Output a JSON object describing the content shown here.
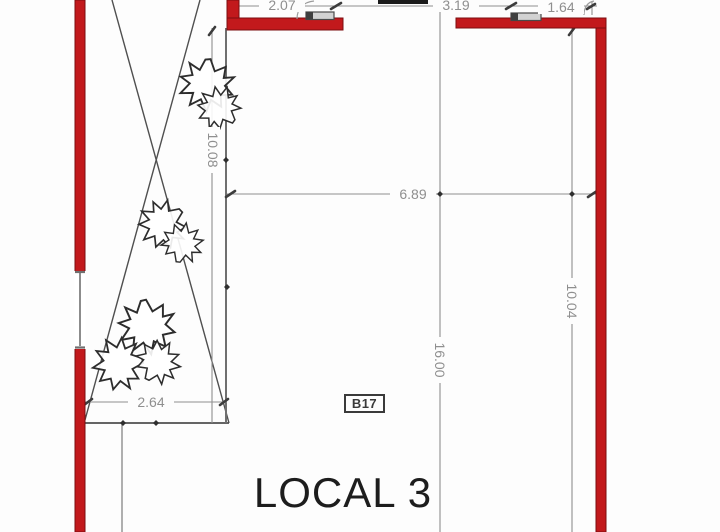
{
  "plan": {
    "room_label": "LOCAL 3",
    "unit_code": "B17",
    "dimensions": {
      "top_left": "2.07",
      "top_middle": "3.19",
      "top_right": "1.64",
      "left_height": "10.08",
      "interior_width": "6.89",
      "center_height": "16.00",
      "right_height": "10.04",
      "planter_width": "2.64"
    },
    "colors": {
      "wall_fill": "#c2191c",
      "wall_edge": "#7c0d10",
      "dimension_gray": "#8f8f8f",
      "structure_gray": "#6f6f6f",
      "hatch_dark": "#4f4f4f",
      "label_text": "#1d1d1d"
    }
  }
}
